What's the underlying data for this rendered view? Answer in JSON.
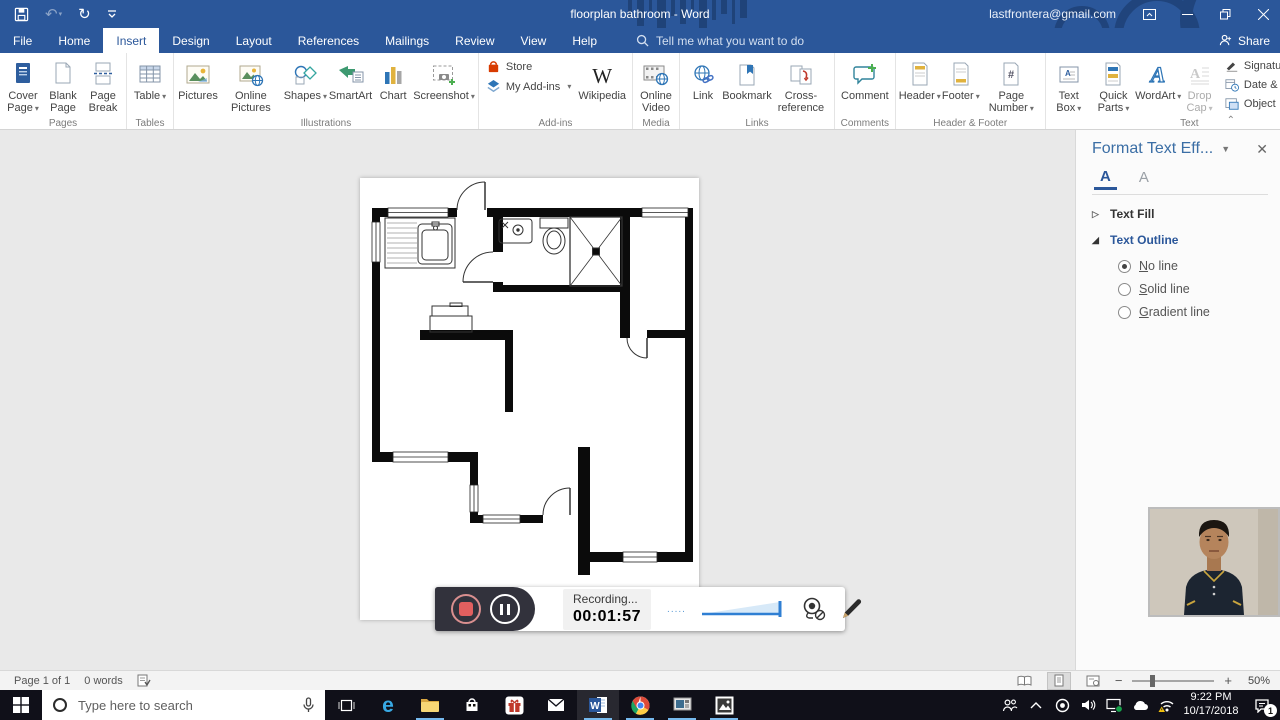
{
  "titlebar": {
    "title": "floorplan bathroom - Word",
    "account": "lastfrontera@gmail.com",
    "share": "Share"
  },
  "tabs": {
    "items": [
      "File",
      "Home",
      "Insert",
      "Design",
      "Layout",
      "References",
      "Mailings",
      "Review",
      "View",
      "Help"
    ],
    "active": "Insert",
    "tellme": "Tell me what you want to do"
  },
  "ribbon": {
    "groups": [
      {
        "name": "Pages",
        "buttons": [
          {
            "label": "Cover Page"
          },
          {
            "label": "Blank Page"
          },
          {
            "label": "Page Break"
          }
        ]
      },
      {
        "name": "Tables",
        "buttons": [
          {
            "label": "Table"
          }
        ]
      },
      {
        "name": "Illustrations",
        "buttons": [
          {
            "label": "Pictures"
          },
          {
            "label": "Online Pictures"
          },
          {
            "label": "Shapes"
          },
          {
            "label": "SmartArt"
          },
          {
            "label": "Chart"
          },
          {
            "label": "Screenshot"
          }
        ]
      },
      {
        "name": "Add-ins",
        "buttons": [
          {
            "label": "Store"
          },
          {
            "label": "My Add-ins"
          },
          {
            "label": "Wikipedia"
          }
        ]
      },
      {
        "name": "Media",
        "buttons": [
          {
            "label": "Online Video"
          }
        ]
      },
      {
        "name": "Links",
        "buttons": [
          {
            "label": "Link"
          },
          {
            "label": "Bookmark"
          },
          {
            "label": "Cross-reference"
          }
        ]
      },
      {
        "name": "Comments",
        "buttons": [
          {
            "label": "Comment"
          }
        ]
      },
      {
        "name": "Header & Footer",
        "buttons": [
          {
            "label": "Header"
          },
          {
            "label": "Footer"
          },
          {
            "label": "Page Number"
          }
        ]
      },
      {
        "name": "Text",
        "buttons": [
          {
            "label": "Text Box"
          },
          {
            "label": "Quick Parts"
          },
          {
            "label": "WordArt"
          },
          {
            "label": "Drop Cap"
          },
          {
            "label": "Signature Line"
          },
          {
            "label": "Date & Time"
          },
          {
            "label": "Object"
          }
        ]
      },
      {
        "name": "Symbols",
        "buttons": [
          {
            "label": "Equation"
          },
          {
            "label": "Symbol"
          }
        ]
      }
    ]
  },
  "panel": {
    "title": "Format Text Eff...",
    "sections": [
      {
        "label": "Text Fill"
      },
      {
        "label": "Text Outline"
      }
    ],
    "radios": [
      {
        "u": "N",
        "rest": "o line"
      },
      {
        "u": "S",
        "rest": "olid line"
      },
      {
        "u": "G",
        "rest": "radient line"
      }
    ]
  },
  "recording": {
    "status": "Recording...",
    "time": "00:01:57",
    "dots": "....."
  },
  "statusbar": {
    "page": "Page 1 of 1",
    "words": "0 words",
    "zoom": "50%"
  },
  "taskbar": {
    "search_placeholder": "Type here to search",
    "clock_time": "9:22 PM",
    "clock_date": "10/17/2018",
    "notification_count": "1"
  }
}
